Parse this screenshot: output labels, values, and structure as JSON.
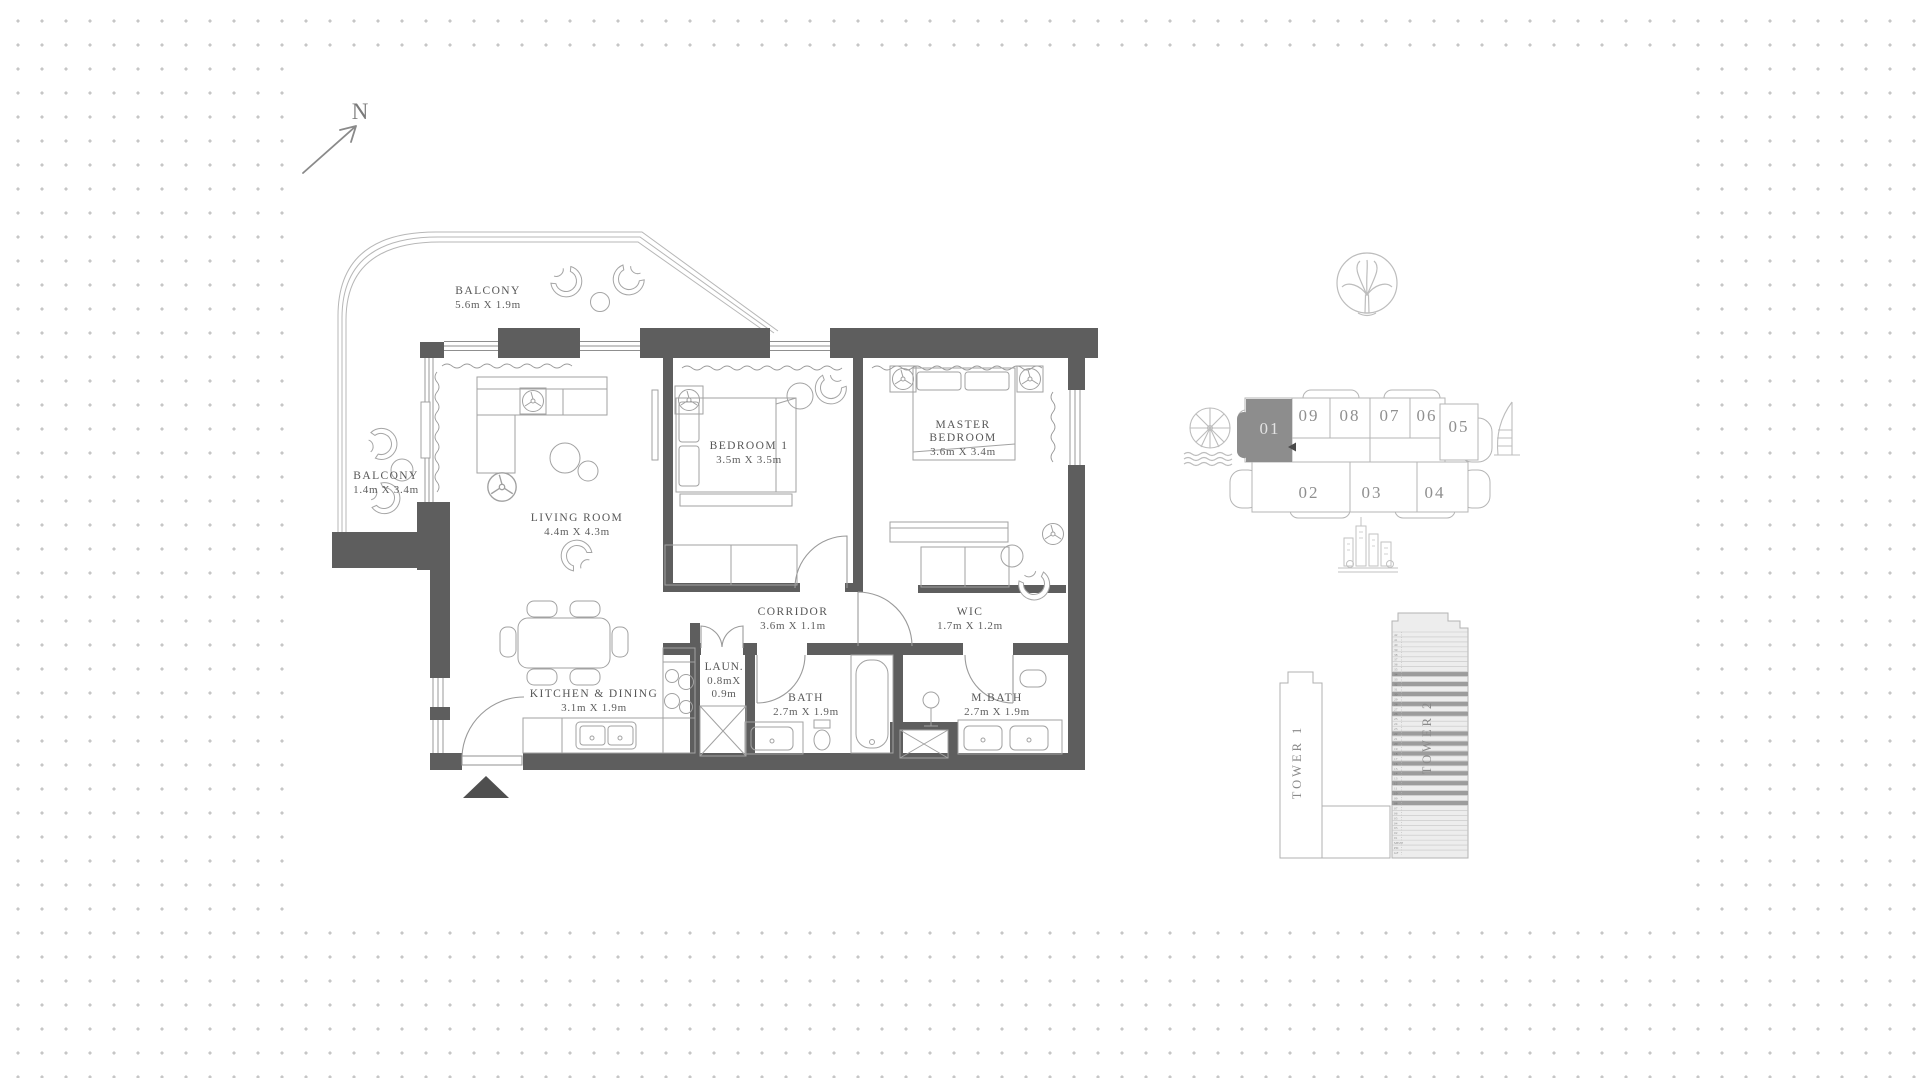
{
  "compass": {
    "label": "N"
  },
  "floor_plan": {
    "rooms": [
      {
        "id": "balcony-top",
        "name": "BALCONY",
        "dims": "5.6m X 1.9m"
      },
      {
        "id": "balcony-left",
        "name": "BALCONY",
        "dims": "1.4m X 3.4m"
      },
      {
        "id": "living-room",
        "name": "LIVING ROOM",
        "dims": "4.4m X 4.3m"
      },
      {
        "id": "bedroom-1",
        "name": "BEDROOM 1",
        "dims": "3.5m X 3.5m"
      },
      {
        "id": "master-bedroom",
        "name": "MASTER BEDROOM",
        "dims": "3.6m X 3.4m"
      },
      {
        "id": "corridor",
        "name": "CORRIDOR",
        "dims": "3.6m X 1.1m"
      },
      {
        "id": "wic",
        "name": "WIC",
        "dims": "1.7m X 1.2m"
      },
      {
        "id": "laundry",
        "name": "LAUN.",
        "dims": "0.8mX 0.9m"
      },
      {
        "id": "bath",
        "name": "BATH",
        "dims": "2.7m X 1.9m"
      },
      {
        "id": "master-bath",
        "name": "M.BATH",
        "dims": "2.7m X 1.9m"
      },
      {
        "id": "kitchen-dining",
        "name": "KITCHEN & DINING",
        "dims": "3.1m X 1.9m"
      }
    ]
  },
  "key_plan": {
    "highlighted_unit": "01",
    "highlight_color": "#8d8d8d",
    "units": [
      "01",
      "09",
      "08",
      "07",
      "06",
      "05",
      "02",
      "03",
      "04"
    ]
  },
  "towers": {
    "tower1_label": "TOWER 1",
    "tower2_label": "TOWER 2",
    "tower2_floors": [
      "42",
      "41",
      "40",
      "39",
      "38",
      "37",
      "36",
      "35",
      "34",
      "33",
      "32",
      "31",
      "30",
      "29",
      "28",
      "27",
      "26",
      "25",
      "24",
      "23",
      "22",
      "21",
      "20",
      "19",
      "18",
      "17",
      "16",
      "15",
      "14",
      "13",
      "12",
      "11",
      "10",
      "09",
      "08",
      "07",
      "06",
      "05",
      "04",
      "03",
      "02",
      "01",
      "MEZZ",
      "PD",
      "GF"
    ],
    "tower2_dark_floors": [
      "34",
      "32",
      "30",
      "28",
      "26",
      "22",
      "20",
      "18",
      "16",
      "14",
      "12",
      "10",
      "08"
    ]
  }
}
